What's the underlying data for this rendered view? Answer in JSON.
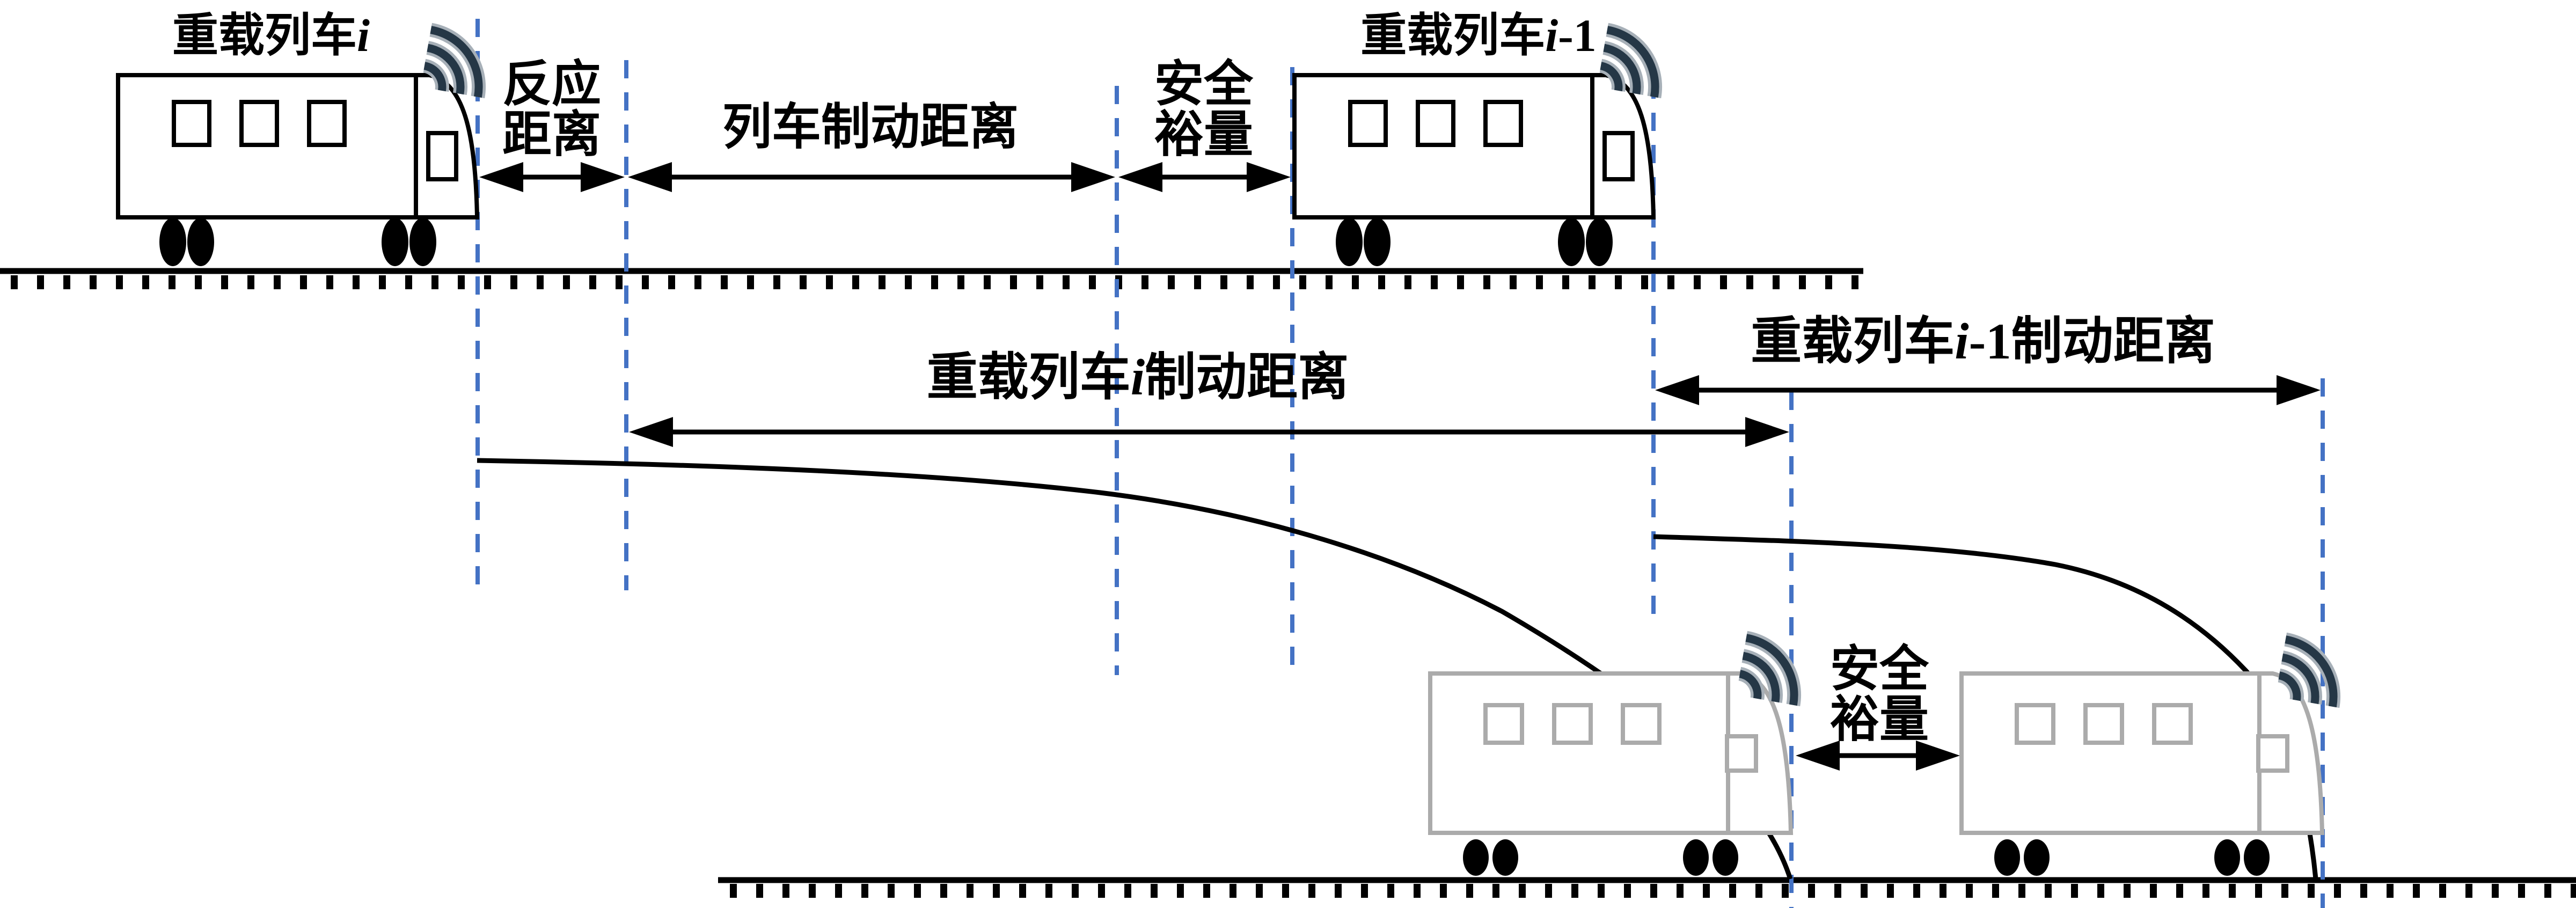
{
  "colors": {
    "background": "#ffffff",
    "outline": "#000000",
    "dashed_guide": "#4472c4",
    "ghost_train": "#ababab",
    "wifi_icon": "#253746",
    "text": "#000000"
  },
  "icons": {
    "wifi": "wifi-waves-icon"
  },
  "labels": {
    "train_i": {
      "prefix": "重载列车",
      "index": "i"
    },
    "train_i1": {
      "prefix": "重载列车",
      "index": "i",
      "index_suffix": "-1"
    },
    "reaction_distance": {
      "line1": "反应",
      "line2": "距离"
    },
    "train_braking_distance": "列车制动距离",
    "safety_margin_top": {
      "line1": "安全",
      "line2": "裕量"
    },
    "train_i_braking_distance": {
      "prefix": "重载列车",
      "index": "i",
      "suffix": "制动距离"
    },
    "train_i1_braking_distance": {
      "prefix": "重载列车",
      "index": "i",
      "index_suffix": "-1",
      "suffix": "制动距离"
    },
    "safety_margin_bottom": {
      "line1": "安全",
      "line2": "裕量"
    }
  }
}
